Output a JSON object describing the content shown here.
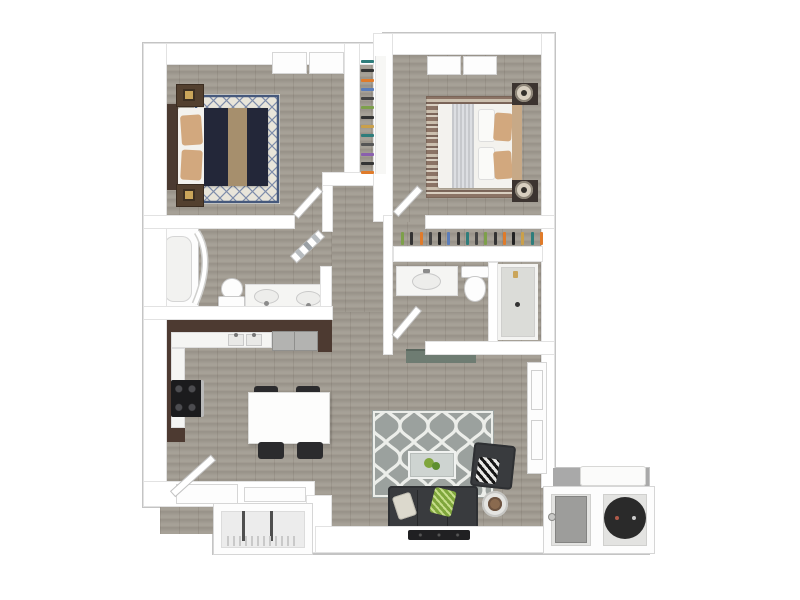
{
  "scene": {
    "kind": "3d-floor-plan-top-view",
    "description": "Two bedroom / two bathroom apartment floor plan rendered in 3D top-down view, no text labels",
    "background": "#ffffff"
  },
  "palette": {
    "wall_white": "#ffffff",
    "wall_edge": "#e2e2e2",
    "outline": "#c4c4c4",
    "floor_wood": "#a19b91",
    "cabinet_brown": "#4d3a31",
    "counter": "#f5f5f3",
    "appliance_gray": "#b3b3b1",
    "stove_black": "#1b1b1d",
    "bed1_navy": "#232739",
    "runner_tan": "#a68f6d",
    "pillow_tan": "#d2a87e",
    "nightstand_brown": "#53402f",
    "rug1_cream": "#e8e5da",
    "rug1_navy": "#46597c",
    "bed2_white": "#f3f2ee",
    "headboard_tan": "#c7a987",
    "rug2_brown": "#8b7365",
    "rug2_cream": "#d8cec0",
    "sofa_charcoal": "#393b3e",
    "rug_gray": "#9ba19e",
    "rug_white": "#eceeea",
    "plant_green": "#7fa63c",
    "shower_pan": "#dbdcd8",
    "patio_gray": "#a9a9a9",
    "patio_light": "#ececec",
    "heater_gray": "#9d9d9b",
    "hvac_black": "#2a2a2a",
    "console_slate": "#6e7c72",
    "blue_art": "#6b87b5",
    "lamp_cream": "#d8cfc0",
    "chair_dark": "#2b2b2d"
  },
  "rooms": [
    {
      "id": "bedroom-1",
      "furniture": [
        "double-bed-navy",
        "nightstand",
        "nightstand",
        "lattice-area-rug",
        "wall-art",
        "double-window"
      ]
    },
    {
      "id": "bedroom-2",
      "furniture": [
        "double-bed-white",
        "nightstand-with-lamp",
        "nightstand-with-lamp",
        "striped-area-rug",
        "double-window"
      ]
    },
    {
      "id": "closet-1",
      "furniture": [
        "hanging-clothes",
        "shelf"
      ]
    },
    {
      "id": "closet-2",
      "furniture": [
        "hanging-clothes",
        "shelf"
      ]
    },
    {
      "id": "bathroom-1",
      "furniture": [
        "bathtub",
        "shower-curtain",
        "toilet",
        "double-sink-vanity",
        "towel-door"
      ]
    },
    {
      "id": "bathroom-2",
      "furniture": [
        "sink-vanity",
        "toilet",
        "walk-in-shower"
      ]
    },
    {
      "id": "kitchen",
      "furniture": [
        "l-shaped-cabinets",
        "range",
        "double-sink",
        "refrigerator"
      ]
    },
    {
      "id": "dining",
      "furniture": [
        "dining-table",
        "chair",
        "chair",
        "chair",
        "chair"
      ]
    },
    {
      "id": "living-room",
      "furniture": [
        "sofa",
        "armchair",
        "coffee-table",
        "plant",
        "side-table",
        "quatrefoil-area-rug",
        "media-console",
        "soundbar"
      ]
    },
    {
      "id": "entry",
      "furniture": [
        "entry-door",
        "console-ledges"
      ]
    },
    {
      "id": "patio-storage",
      "furniture": [
        "wire-shelving"
      ]
    },
    {
      "id": "utility-patio",
      "furniture": [
        "patio-table",
        "water-heater",
        "hvac-condenser"
      ]
    }
  ],
  "closets": {
    "closet1": [
      "#2e7d7b",
      "#333333",
      "#e07b2a",
      "#5a7dbb",
      "#444444",
      "#7da04a",
      "#333333",
      "#caa04a",
      "#2e7d7b",
      "#555555",
      "#8a5fae",
      "#333333",
      "#e07b2a"
    ],
    "closet2": [
      "#7da04a",
      "#333333",
      "#e07b2a",
      "#444444",
      "#222222",
      "#5a7dbb",
      "#333333",
      "#2e7d7b",
      "#444444",
      "#7da04a",
      "#333333",
      "#e07b2a",
      "#222222",
      "#caa04a",
      "#2e7d7b",
      "#e07b2a"
    ]
  }
}
